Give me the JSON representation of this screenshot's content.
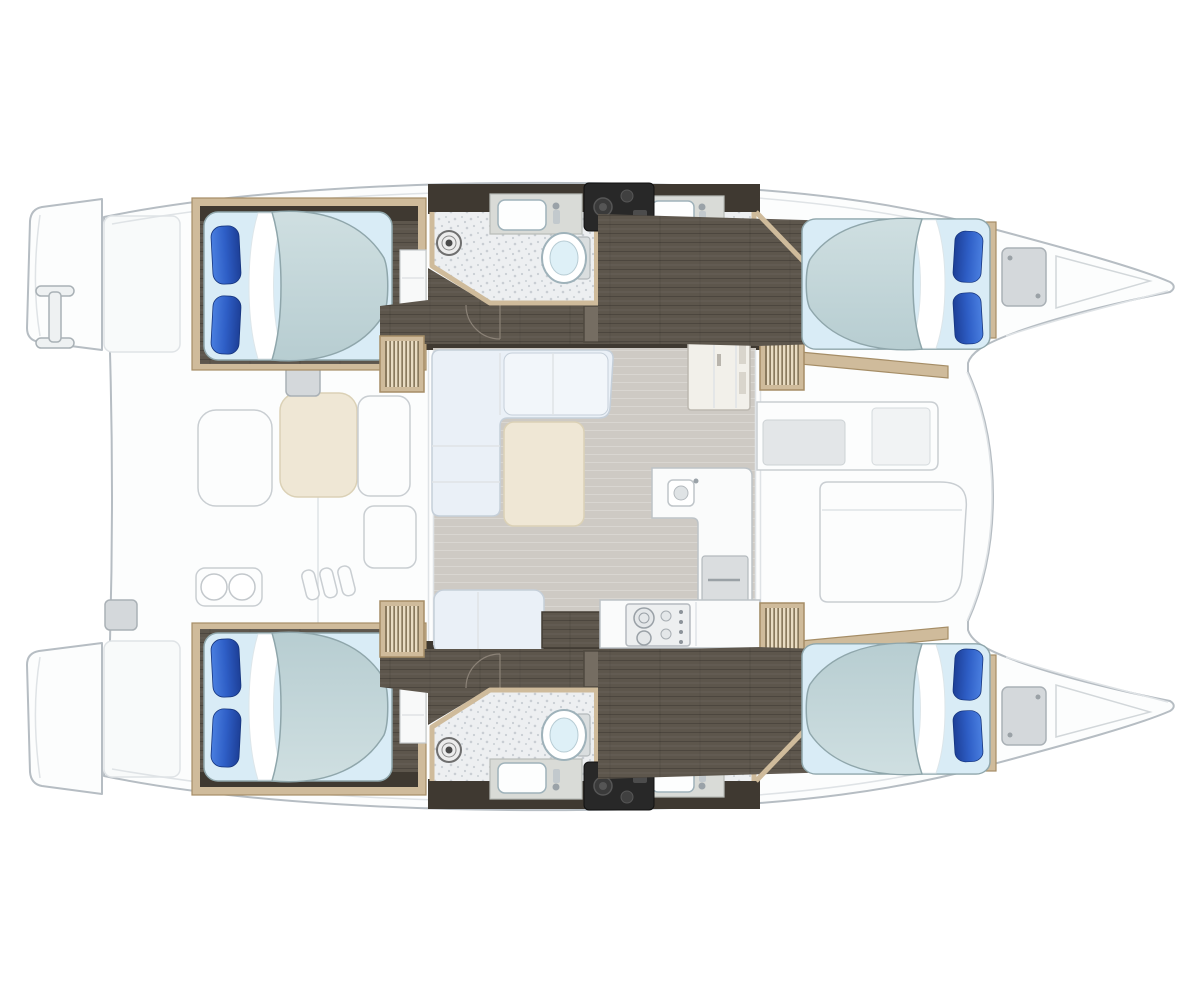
{
  "diagram": {
    "type": "floorplan",
    "subject": "Catamaran sailing yacht interior deck plan, top view, bow to the right",
    "layout_symmetry": "port and starboard hulls mirrored",
    "rooms": {
      "double_cabins": 4,
      "bathrooms": 4,
      "salon": 1,
      "galley": 1,
      "aft_cockpit": 1,
      "forward_cockpit": 1
    },
    "fixtures": {
      "double_berths": 4,
      "pillows_per_berth": 2,
      "toilets": 4,
      "bathroom_sinks": 4,
      "shower_drains": 4,
      "companionway_step_units": 4,
      "stove_burners": 2,
      "galley_sink": 1,
      "salon_sofa": "L-shaped with chaise",
      "coffee_table": 1,
      "cockpit_table": 1,
      "swim_platforms": 2,
      "boarding_ladder": 1,
      "bow_deck_hatches": 2
    }
  },
  "palette": {
    "page_bg": "#ffffff",
    "boat_outline": "#b6bdc3",
    "deck_white": "#fcfdfd",
    "deck_line": "#dfe3e6",
    "wall_dark": "#3f3931",
    "floor_dark": "#5d564c",
    "wood_trim": "#cfbb9b",
    "wood_trim_dark": "#a58d66",
    "slat_light": "#e9dcc3",
    "slat_mid": "#8a7a5e",
    "bathroom_floor": "#edeff1",
    "bathroom_speckle": "#c9ced3",
    "counter_gray": "#d9dbd7",
    "fixture_white": "#fdfefe",
    "fixture_stroke": "#9fb2ba",
    "toilet_water": "#def0f7",
    "mattress": "#b7cdd1",
    "mattress_hi": "#cfdfe1",
    "mattress_stroke": "#8fa6ab",
    "sheet_base": "#d9ecf6",
    "pillow_light": "#4a7fe0",
    "pillow_mid": "#2e5ec6",
    "pillow_dark": "#1d3f97",
    "salon_floor": "#cecac4",
    "sofa_fill": "#eaf0f7",
    "sofa_stroke": "#c5cfd9",
    "table_cream": "#efe7d5",
    "table_stroke": "#dbd1b6",
    "counter_white": "#fafbfb",
    "counter_stroke": "#bdc3c7",
    "stove_panel": "#edeff0",
    "equip_black": "#282828",
    "hatch_gray": "#d4d8db"
  }
}
